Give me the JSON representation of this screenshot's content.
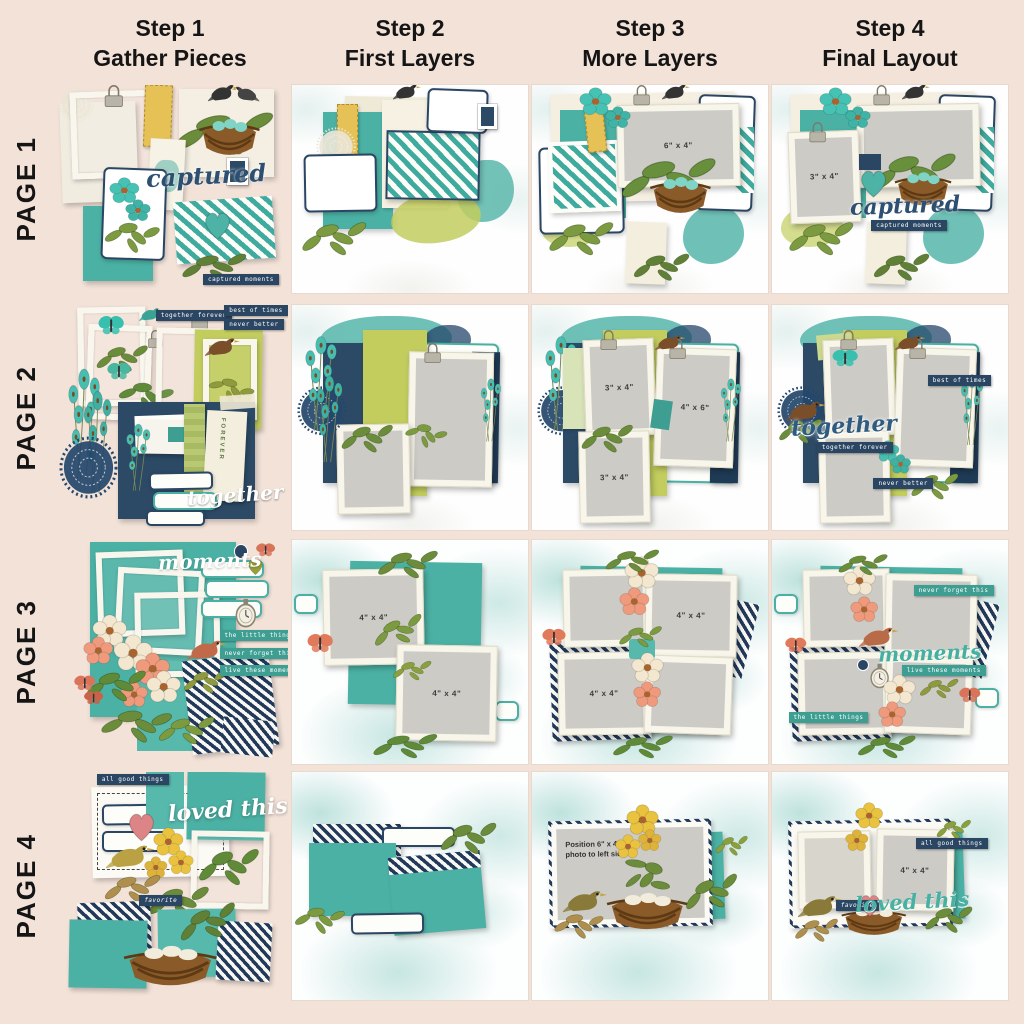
{
  "header": {
    "columns": [
      {
        "title": "Step 1",
        "subtitle": "Gather Pieces"
      },
      {
        "title": "Step 2",
        "subtitle": "First Layers"
      },
      {
        "title": "Step 3",
        "subtitle": "More Layers"
      },
      {
        "title": "Step 4",
        "subtitle": "Final Layout"
      }
    ]
  },
  "rows": [
    {
      "label": "PAGE 1"
    },
    {
      "label": "PAGE 2"
    },
    {
      "label": "PAGE 3"
    },
    {
      "label": "PAGE 4"
    }
  ],
  "colors": {
    "page_background": "#f2e2d8",
    "teal": "#4bb1a4",
    "navy": "#2a4663",
    "lime": "#c2cd5e",
    "photo_gray": "#cccbc6",
    "cream": "#efe8d4",
    "coral": "#e0846a",
    "yellow": "#e6c256",
    "script_navy": "#2d4f72",
    "script_teal": "#48b1a3"
  },
  "page1": {
    "script": "captured",
    "strip": "captured moments",
    "step3_photo": "6\" x 4\"",
    "step4_photo": "3\" x 4\""
  },
  "page2": {
    "script": "together",
    "strips": {
      "a": "together forever",
      "b": "best of times",
      "c": "never better"
    },
    "tag_text": "FOREVER",
    "step3_photos": {
      "p1": "3\" x 4\"",
      "p2": "4\" x 6\"",
      "p3": "3\" x 4\""
    }
  },
  "page3": {
    "script": "moments",
    "strips": {
      "a": "the little things",
      "b": "never forget this",
      "c": "live these moments"
    },
    "step2_photos": {
      "p1": "4\" x 4\"",
      "p2": "4\" x 4\""
    },
    "step3_photos": {
      "p1": "4\" x 4\"",
      "p2": "4\" x 4\""
    }
  },
  "page4": {
    "script": "loved this",
    "strips": {
      "a": "all good things",
      "b": "favorite"
    },
    "step3_note": "Position 6\" x 4\" photo to left side",
    "step4_photo": "4\" x 4\""
  }
}
